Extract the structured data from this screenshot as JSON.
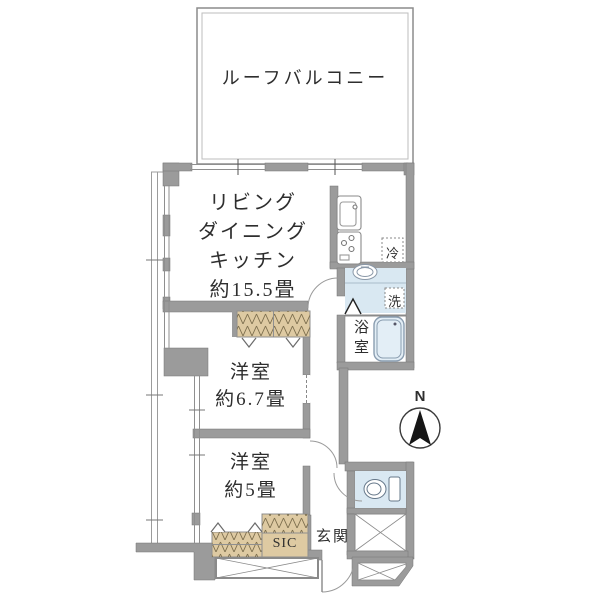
{
  "plan": {
    "balcony": {
      "label": "ルーフバルコニー"
    },
    "ldk": {
      "lines": [
        "リビング",
        "ダイニング",
        "キッチン",
        "約15.5畳"
      ]
    },
    "bedroom1": {
      "lines": [
        "洋室",
        "約6.7畳"
      ]
    },
    "bedroom2": {
      "lines": [
        "洋室",
        "約5畳"
      ]
    },
    "bath": {
      "label": "浴室"
    },
    "washer": {
      "label": "洗"
    },
    "fridge": {
      "label": "冷"
    },
    "entrance": {
      "label": "玄関"
    },
    "sic": {
      "label": "SIC"
    },
    "compass": {
      "label": "N"
    },
    "colors": {
      "wall": "#9b9b9b",
      "water": "#d9e8f2",
      "closet": "#decaa2",
      "text": "#2e2e2e"
    }
  }
}
